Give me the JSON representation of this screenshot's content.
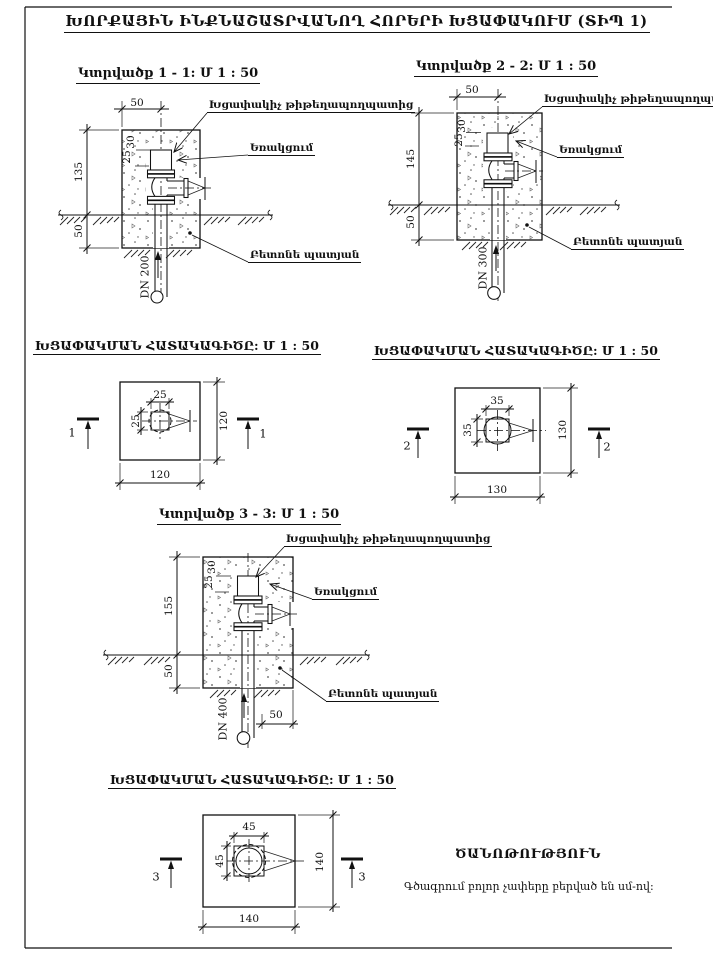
{
  "page": {
    "title": "ԽՈՐՔԱՅԻՆ ԻՆՔՆԱՇԱՏՐՎԱՆՈՂ ՀՈՐԵՐԻ ԽՑԱՓԱԿՈՒՄ (ՏԻՊ 1)"
  },
  "labels": {
    "cap": "Խցափակիչ թիթեղապողպատից",
    "weld": "Եռակցում",
    "casing": "Բետոնե պատյան"
  },
  "sections": {
    "s1": {
      "title": "Կտրվածք 1 - 1: Մ 1 : 50",
      "top_width": "50",
      "height_above": "135",
      "height_below": "50",
      "cap_depth": "30",
      "cap_height": "25",
      "pipe": "DN 200"
    },
    "s2": {
      "title": "Կտրվածք 2 - 2: Մ 1 : 50",
      "top_width": "50",
      "height_above": "145",
      "height_below": "50",
      "cap_depth": "30",
      "cap_height": "25",
      "pipe": "DN 300"
    },
    "s3": {
      "title": "Կտրվածք 3 - 3: Մ 1 : 50",
      "height_above": "155",
      "height_below": "50",
      "cap_depth": "30",
      "cap_height": "25",
      "pipe": "DN 400",
      "edge_offset": "50"
    }
  },
  "plans": {
    "p1": {
      "title": "ԽՑԱՓԱԿՄԱՆ ՀԱՏԱԿԱԳԻԾԸ: Մ 1 : 50",
      "width": "120",
      "height": "120",
      "inner_width": "25",
      "inner_height": "25",
      "cut": "1"
    },
    "p2": {
      "title": "ԽՑԱՓԱԿՄԱՆ ՀԱՏԱԿԱԳԻԾԸ: Մ 1 : 50",
      "width": "130",
      "height": "130",
      "inner_width": "35",
      "inner_height": "35",
      "cut": "2"
    },
    "p3": {
      "title": "ԽՑԱՓԱԿՄԱՆ ՀԱՏԱԿԱԳԻԾԸ: Մ 1 : 50",
      "width": "140",
      "height": "140",
      "inner_width": "45",
      "inner_height": "45",
      "cut": "3"
    }
  },
  "note": {
    "title": "ԾԱՆՈԹՈՒԹՅՈՒՆ",
    "text": "Գծագրում բոլոր չափերը բերված են սմ-ով:"
  }
}
